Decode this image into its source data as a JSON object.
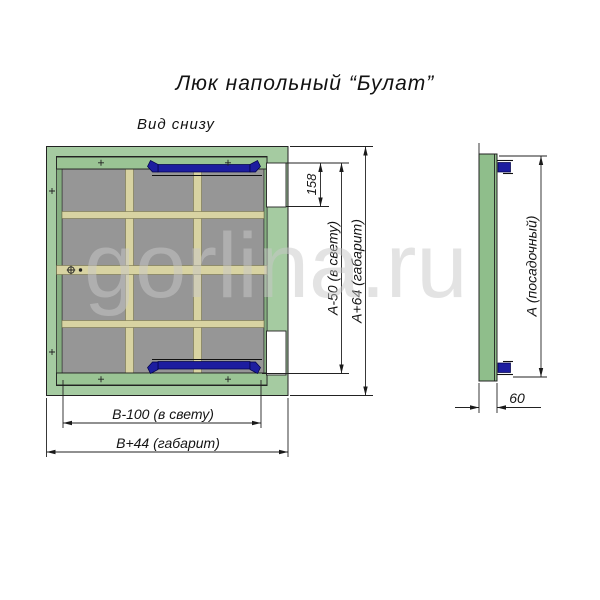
{
  "title": "Люк напольный “Булат”",
  "view_label": "Вид снизу",
  "watermark": "gorlina.ru",
  "main_view": {
    "dims": {
      "notch_height": "158",
      "height_clear": "А-50 (в свету)",
      "height_overall": "А+64 (габарит)",
      "width_clear": "В-100 (в свету)",
      "width_overall": "В+44 (габарит)"
    }
  },
  "side_view": {
    "dims": {
      "height_seat": "А (посадочный)",
      "depth": "60"
    }
  },
  "colors": {
    "frame_green": "#a5cba1",
    "strip_green": "#9ac494",
    "lip_green": "#86ae81",
    "side_green": "#8fbe8b",
    "panel_gray": "#969696",
    "rail_beige": "#d8d3a2",
    "hinge_blue": "#1d1d9f",
    "watermark_gray": "#c9c9c9"
  }
}
